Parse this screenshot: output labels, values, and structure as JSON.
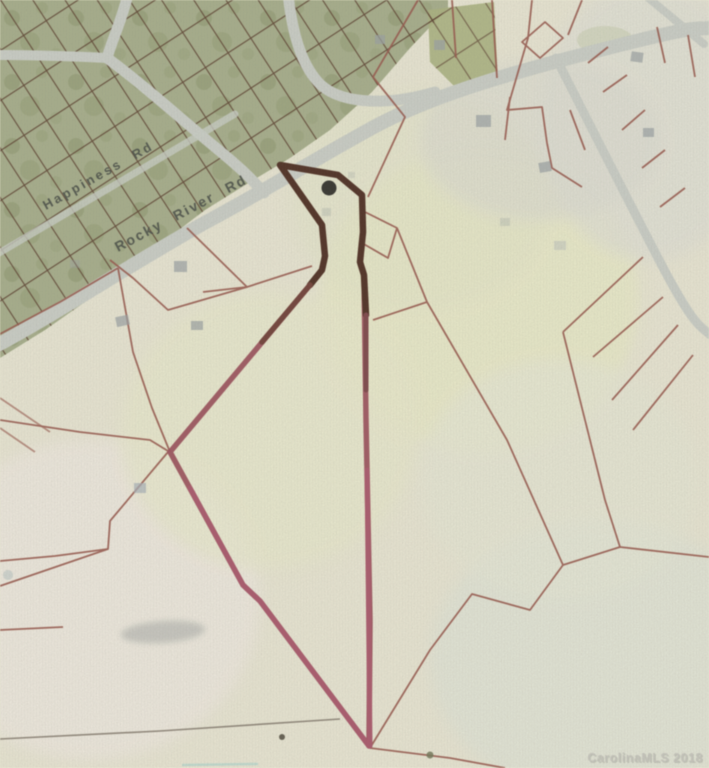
{
  "map": {
    "description": "GIS parcel map photo with highlighted flag-shaped subject parcel",
    "road_labels": [
      {
        "id": "happiness",
        "text": "Happiness Rd"
      },
      {
        "id": "rocky-river",
        "text": "Rocky River Rd"
      }
    ],
    "watermark": {
      "text": "CarolinaMLS 2018"
    },
    "marker": {
      "shape": "dot"
    }
  },
  "colors": {
    "background": "#ece9d3",
    "green_area": "#a5ae85",
    "road": "#cbcfc6",
    "parcel_line": "#9b5244",
    "subdivision_line": "#54301e",
    "highlight_red": "#9f4955",
    "highlight_dark": "#4b2618",
    "highlight_bright": "#b05166",
    "marker_dot": "#2b2a25",
    "building": "#99a0a2",
    "label_text": "#41463f",
    "watermark_text": "#c9c8be"
  }
}
